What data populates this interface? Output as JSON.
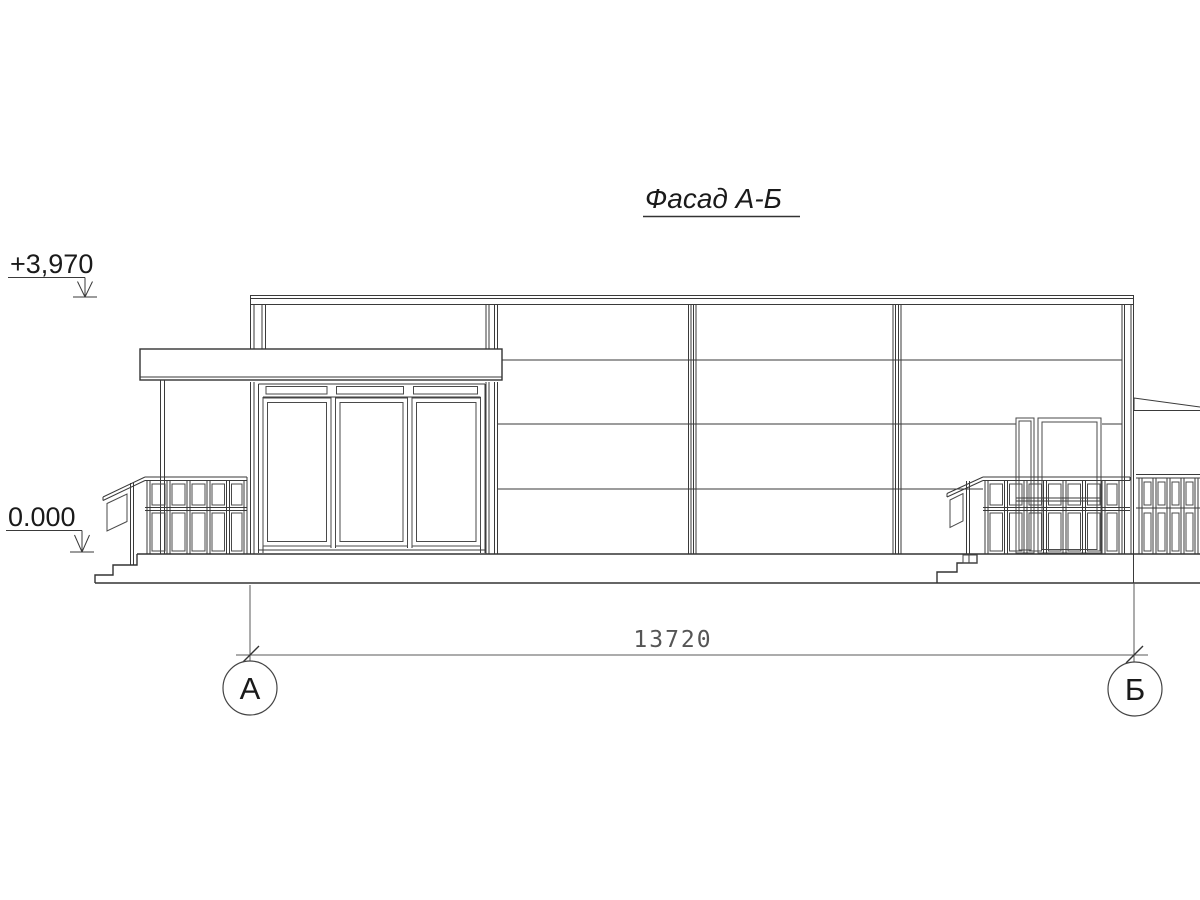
{
  "drawing": {
    "title": "Фасад А-Б",
    "elevation_top": "+3,970",
    "elevation_zero": "0.000",
    "dimension": "13720",
    "axis_left": "А",
    "axis_right": "Б"
  },
  "style": {
    "line_color": "#3a3a3a",
    "dimension_color": "#5a5a5a",
    "background": "#ffffff"
  }
}
